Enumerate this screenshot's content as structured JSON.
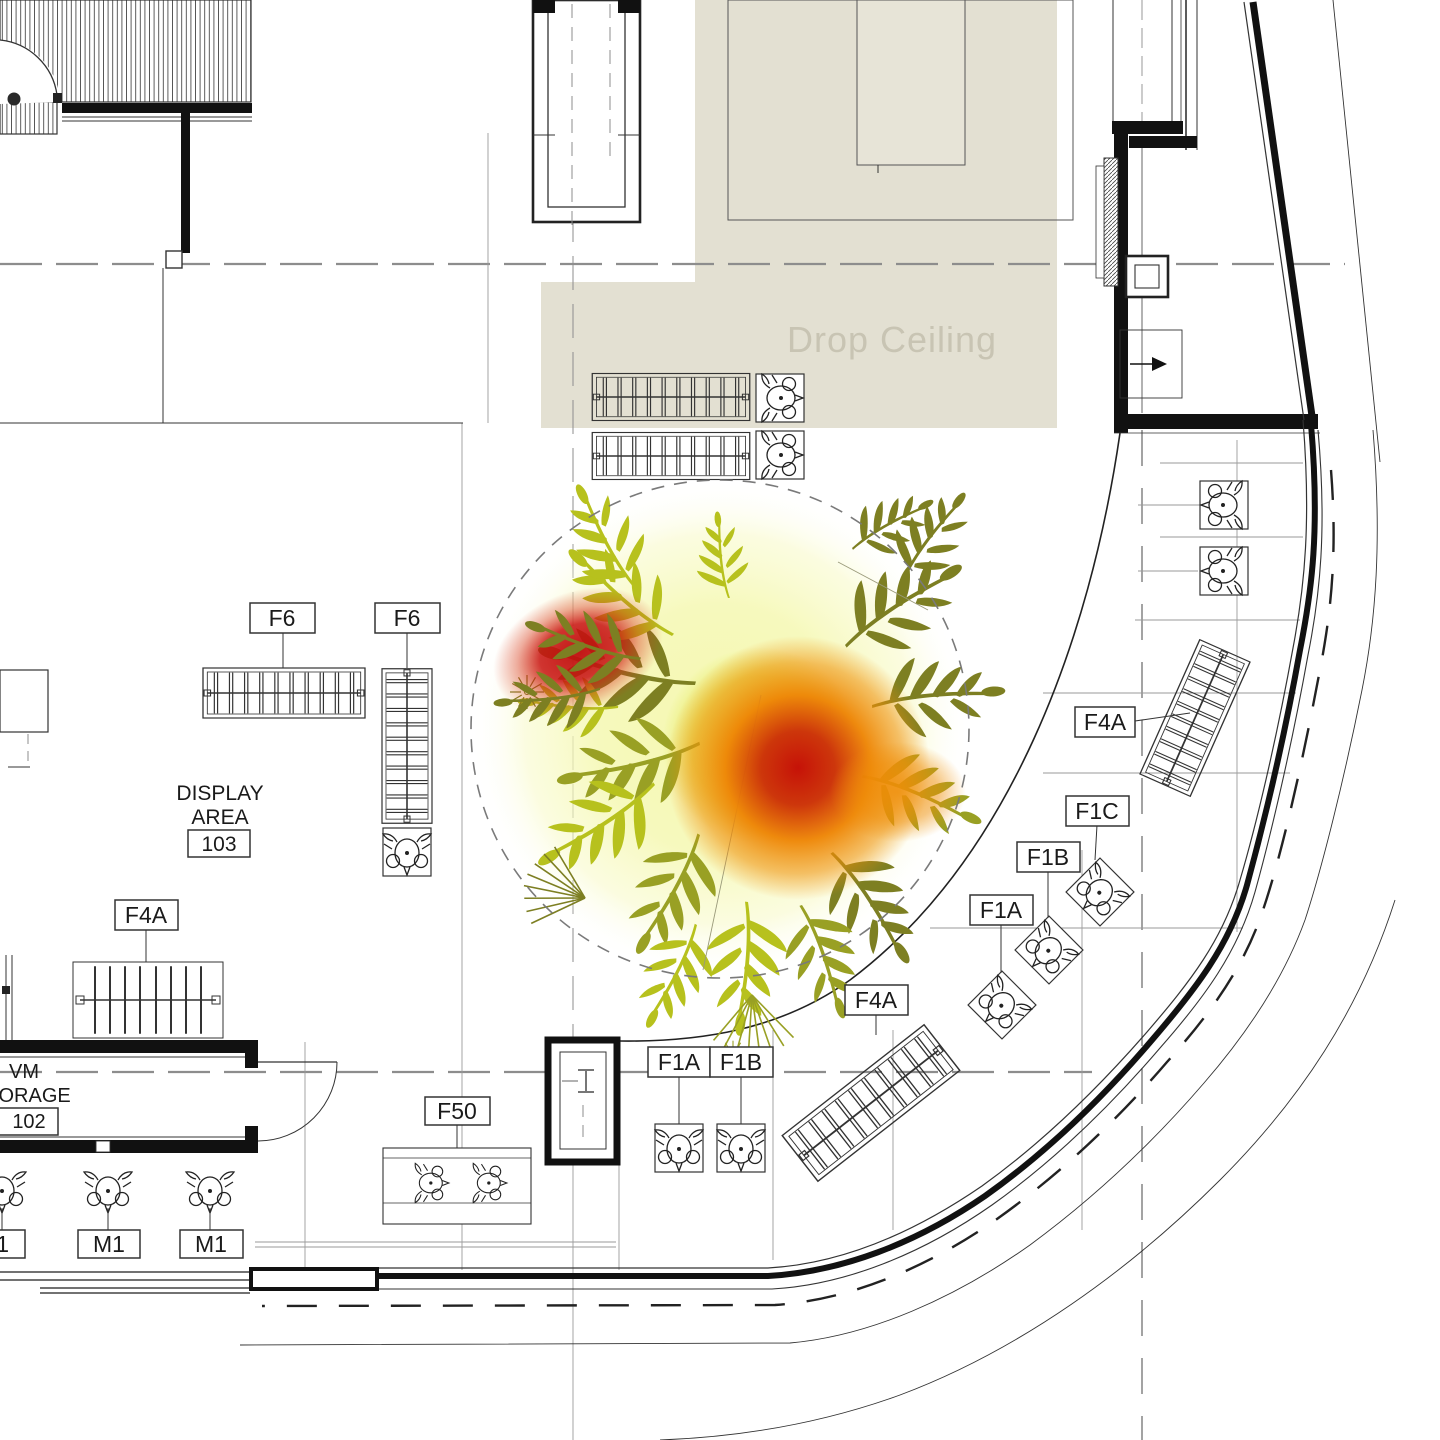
{
  "plan": {
    "drop_ceiling_label": "Drop Ceiling",
    "display_area": {
      "line1": "DISPLAY",
      "line2": "AREA",
      "number": "103"
    },
    "vm_storage": {
      "line1": "VM",
      "line2": "STORAGE",
      "number": "102"
    },
    "fixture_tags": [
      {
        "id": "f6-left",
        "label": "F6"
      },
      {
        "id": "f6-right",
        "label": "F6"
      },
      {
        "id": "f4a-left",
        "label": "F4A"
      },
      {
        "id": "f4a-right",
        "label": "F4A"
      },
      {
        "id": "f1c-right",
        "label": "F1C"
      },
      {
        "id": "f1b-right",
        "label": "F1B"
      },
      {
        "id": "f1a-right",
        "label": "F1A"
      },
      {
        "id": "f4a-bottom",
        "label": "F4A"
      },
      {
        "id": "f1a-pair",
        "label": "F1A"
      },
      {
        "id": "f1b-pair",
        "label": "F1B"
      },
      {
        "id": "f50",
        "label": "F50"
      },
      {
        "id": "m1-left",
        "label": "M1"
      },
      {
        "id": "m1-mid",
        "label": "M1"
      },
      {
        "id": "m1-right",
        "label": "M1"
      }
    ]
  },
  "heatmap": {
    "hotspot_colors": {
      "high": "#c21010",
      "medium": "#ee8a04",
      "low": "#f5f8b2"
    },
    "foliage_colors": {
      "dark": "#7d7f22",
      "bright": "#b7c11d"
    },
    "drop_ceiling_fill": "#e3e0d2"
  }
}
